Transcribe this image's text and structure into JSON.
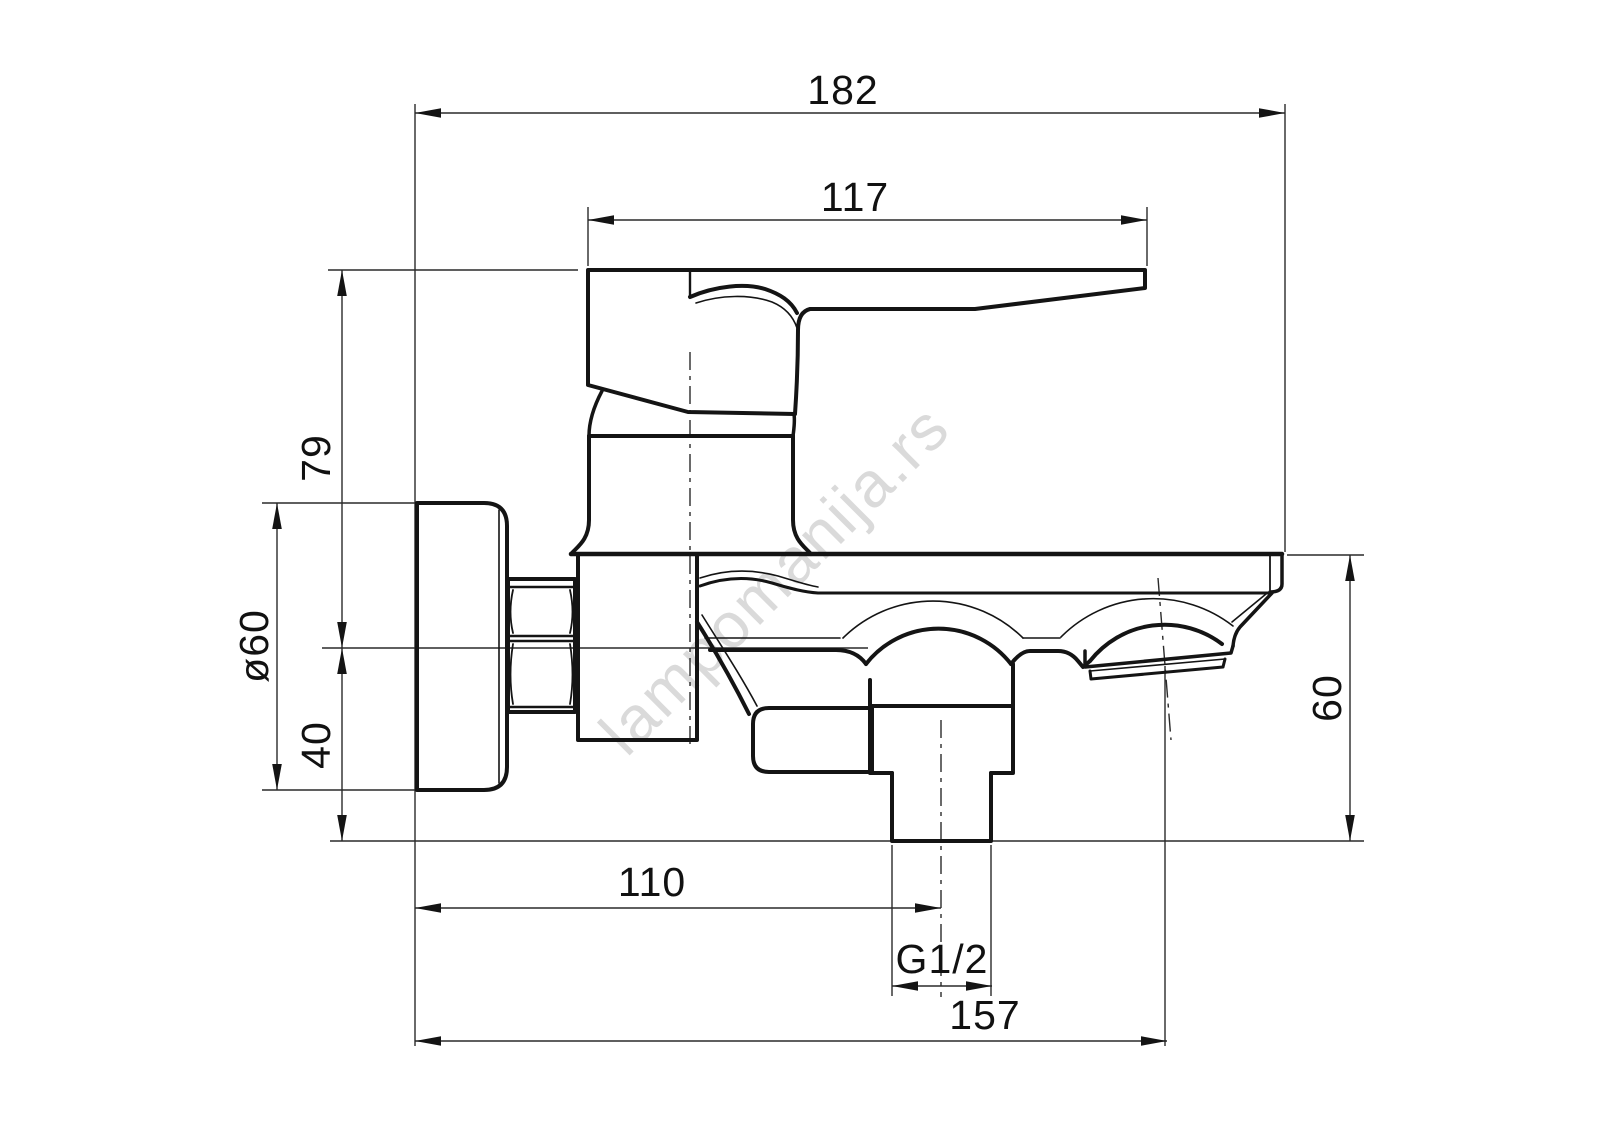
{
  "drawing": {
    "type": "technical-dimension-drawing",
    "subject": "wall-mounted bath mixer faucet, side view",
    "watermark": "lampomanija.rs",
    "colors": {
      "line": "#141414",
      "watermark": "#c7c7c7",
      "background": "#ffffff"
    },
    "dimensions": {
      "overall_depth": "182",
      "handle_length": "117",
      "handle_height_above_axis": "79",
      "flange_diameter": "ø60",
      "axis_to_outlet_bottom": "40",
      "spout_end_drop": "60",
      "wall_to_shower_outlet": "110",
      "thread_size": "G1/2",
      "wall_to_spout_end": "157"
    }
  }
}
